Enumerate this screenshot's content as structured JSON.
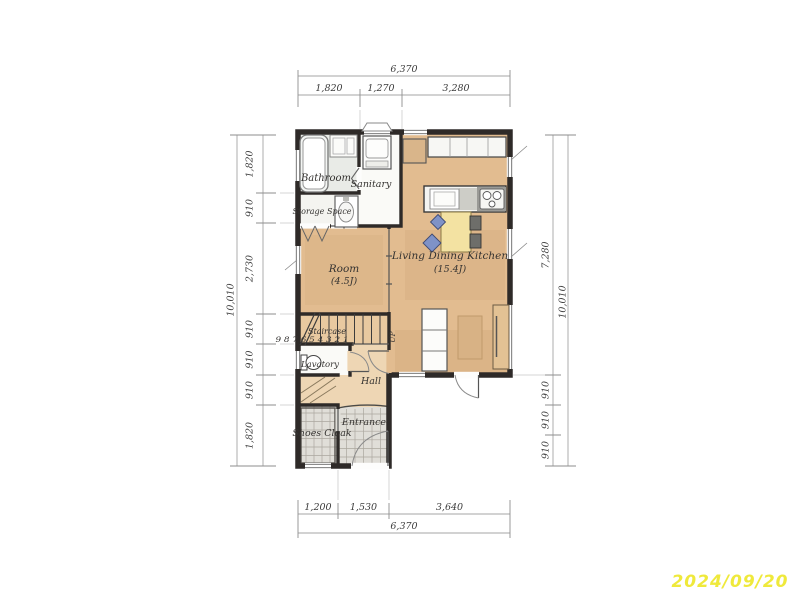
{
  "date": "2024/09/20",
  "dimensions": {
    "top": {
      "total": "6,370",
      "segments": [
        "1,820",
        "1,270",
        "3,280"
      ]
    },
    "bottom": {
      "total": "6,370",
      "segments": [
        "1,200",
        "1,530",
        "3,640"
      ]
    },
    "left": {
      "total": "10,010",
      "segments": [
        "1,820",
        "910",
        "2,730",
        "910",
        "910",
        "910",
        "1,820"
      ]
    },
    "right": {
      "total": "10,010",
      "segments": [
        "7,280",
        "910",
        "910",
        "910"
      ]
    }
  },
  "rooms": {
    "bathroom": {
      "label": "Bathroom"
    },
    "sanitary": {
      "label": "Sanitary"
    },
    "storage": {
      "label": "Storage Space"
    },
    "room": {
      "label": "Room",
      "size": "(4.5J)"
    },
    "ldk": {
      "label": "Living Dining Kitchen",
      "size": "(15.4J)"
    },
    "staircase": {
      "label": "Staircase",
      "steps": "9 8 7 6 5 4 3 2 1",
      "up": "UP"
    },
    "lavatory": {
      "label": "Lavatory"
    },
    "hall": {
      "label": "Hall"
    },
    "entrance": {
      "label": "Entrance"
    },
    "shoes_cloak": {
      "label": "Shoes Cloak"
    }
  },
  "colors": {
    "wall": "#2e2a28",
    "floor_tan": "#e2bc90",
    "hall_tan": "#eed6b4",
    "stair_tan": "#e8c9a0",
    "tile_gray": "#e0ded8",
    "bathroom_gray": "#e9ebe7",
    "white_floor": "#fafaf7",
    "storage_floor": "#f4f4f0",
    "table_yellow": "#f3e2a2",
    "chair_blue": "#7f92c7",
    "wood": "#d9b58a",
    "date_yellow": "#efe93b"
  }
}
